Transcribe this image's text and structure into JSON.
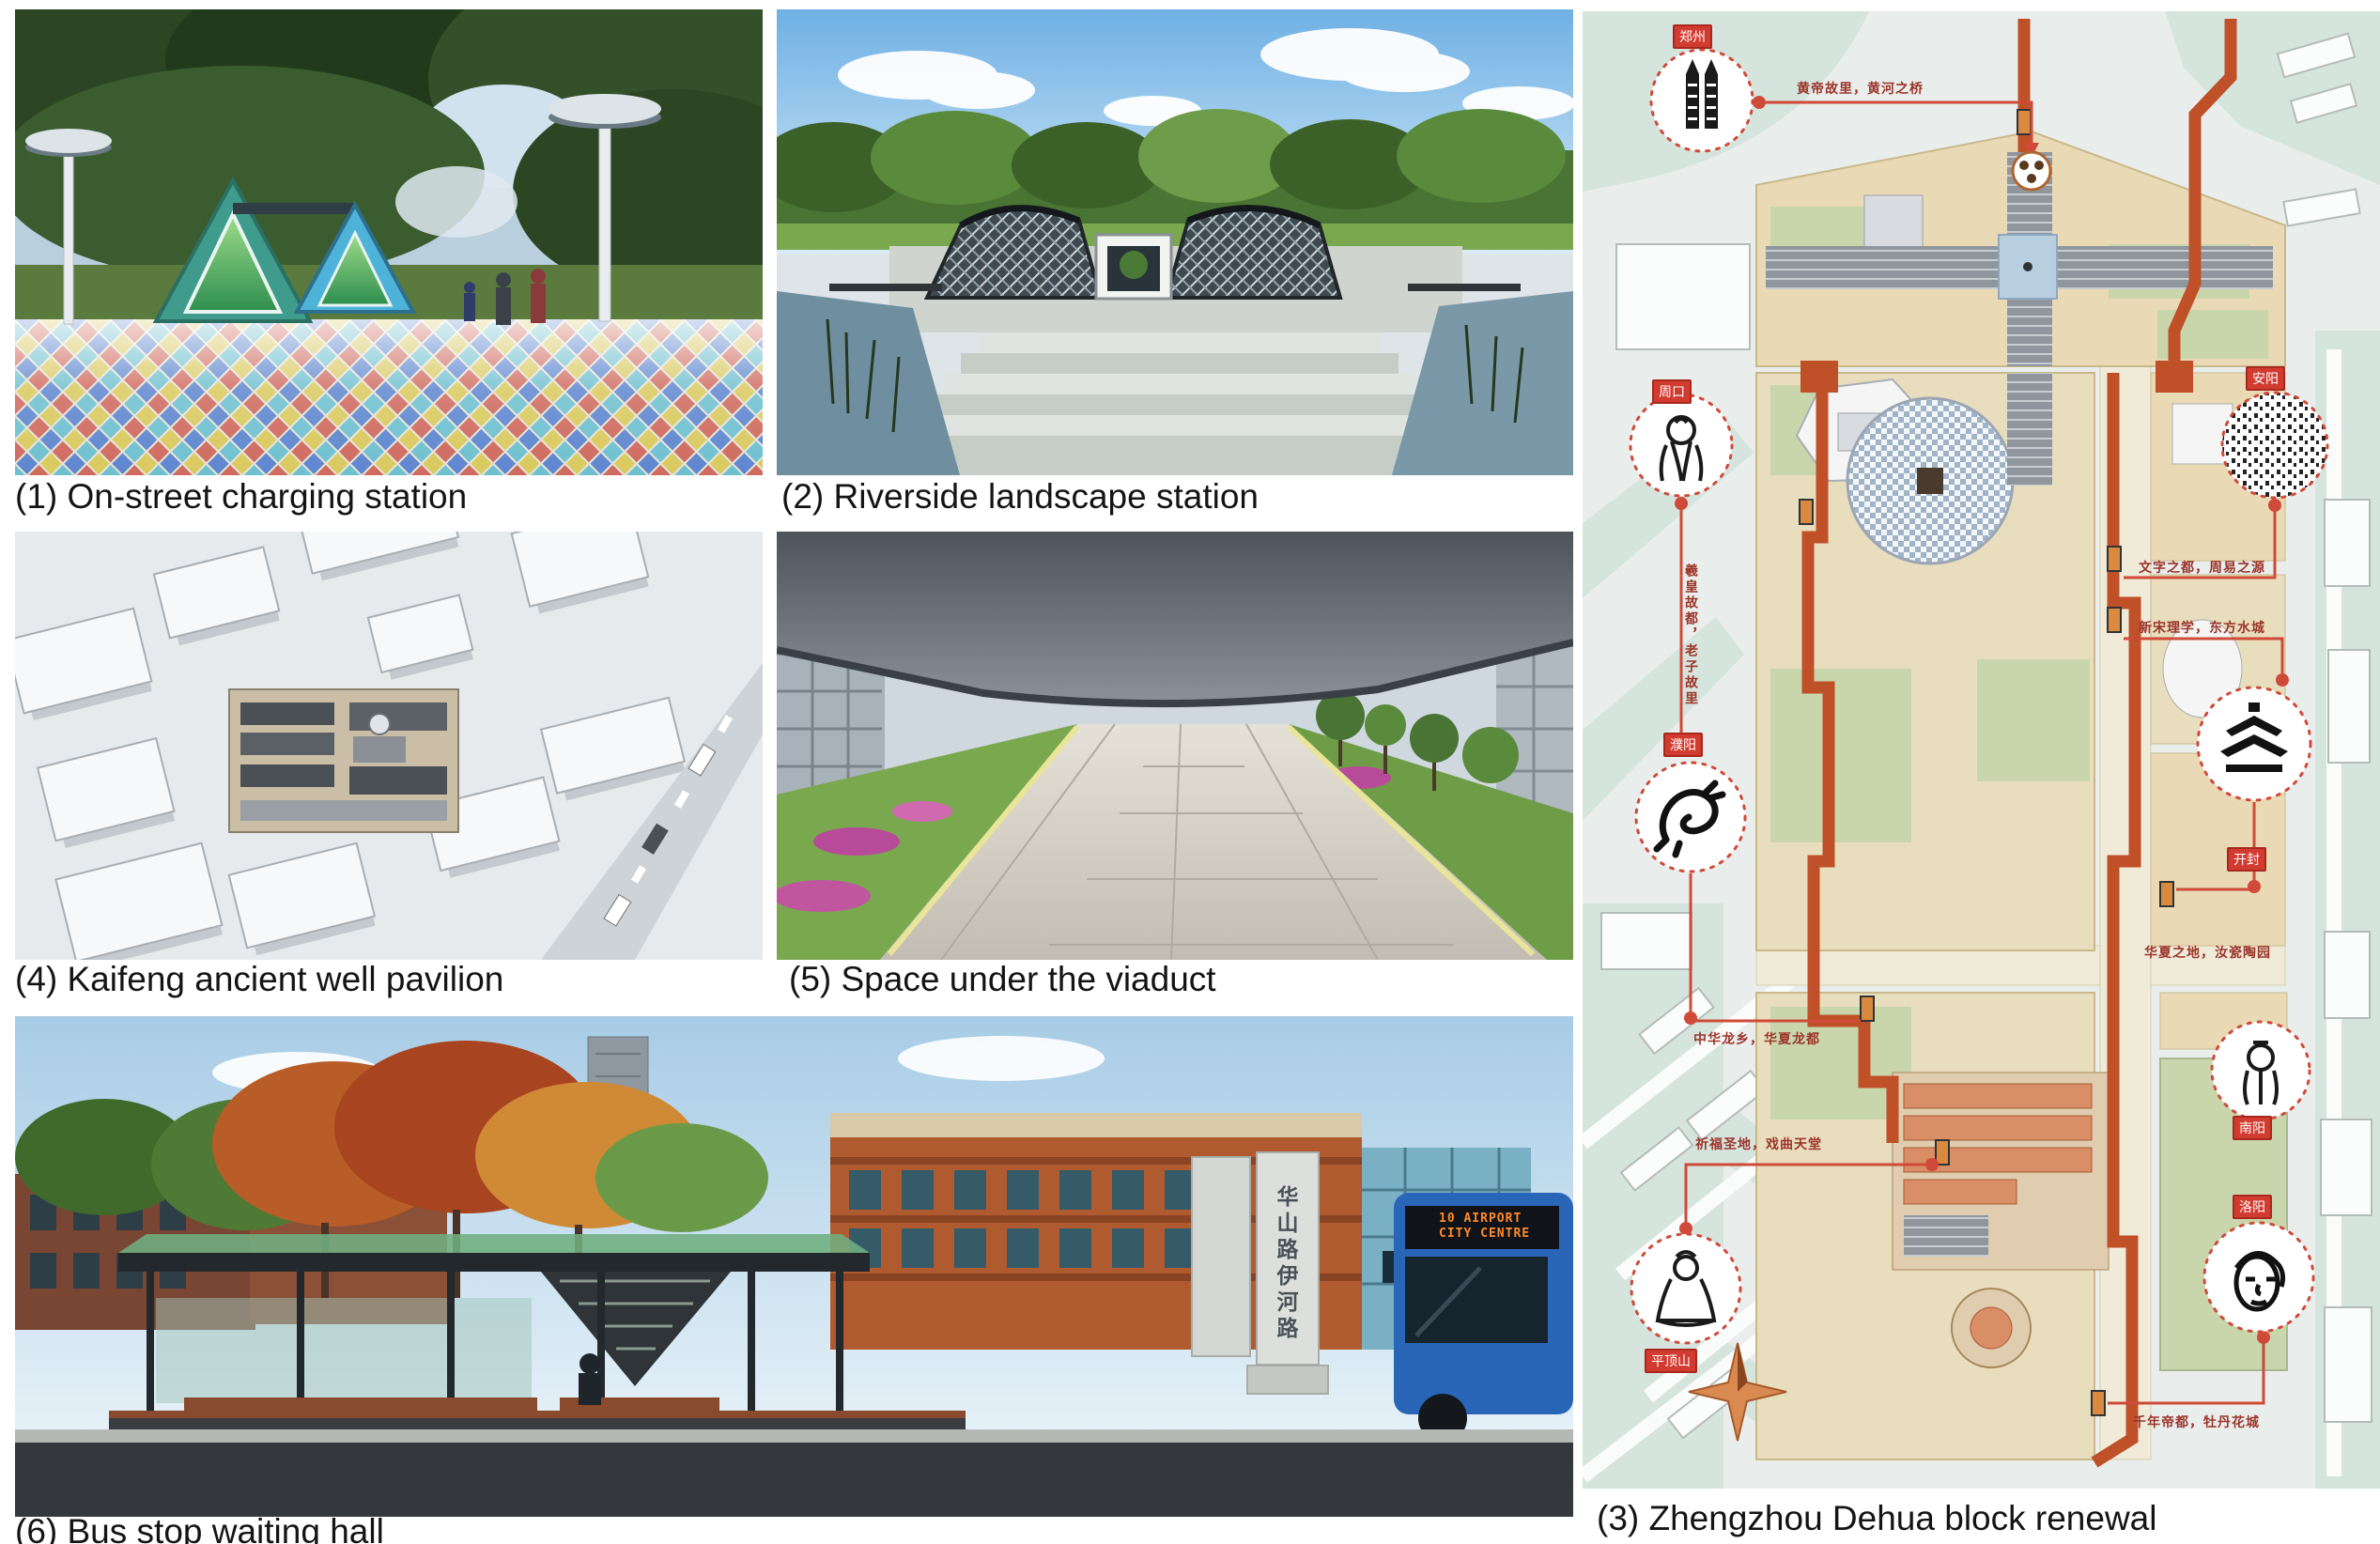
{
  "figure": {
    "captions": {
      "c1": "(1) On-street charging station",
      "c2": "(2) Riverside landscape station",
      "c3": "(3) Zhengzhou Dehua block renewal",
      "c4": "(4) Kaifeng ancient well pavilion",
      "c5": "(5) Space under the viaduct",
      "c6": "(6) Bus stop waiting hall"
    }
  },
  "panel6": {
    "road_sign_vertical": "华山路伊河路",
    "bus_led_line1": "10 AIRPORT",
    "bus_led_line2": "CITY CENTRE"
  },
  "map": {
    "vignettes": [
      {
        "city": "郑州",
        "icon": "erqi-tower-icon"
      },
      {
        "city": "周口",
        "icon": "laozi-portrait-icon"
      },
      {
        "city": "濮阳",
        "icon": "dragon-icon"
      },
      {
        "city": "安阳",
        "icon": "oracle-bone-script-icon"
      },
      {
        "city": "开封",
        "icon": "pagoda-roof-icon"
      },
      {
        "city": "南阳",
        "icon": "scholar-portrait-icon"
      },
      {
        "city": "洛阳",
        "icon": "buddha-head-icon"
      },
      {
        "city": "平顶山",
        "icon": "buddha-statue-icon"
      }
    ],
    "slogans": {
      "zhengzhou": "黄帝故里，黄河之桥",
      "zhoukou": "羲皇故都，老子故里",
      "anyang": "文字之都，周易之源",
      "kaifeng": "新宋理学，东方水城",
      "ruzhou": "华夏之地，汝瓷陶园",
      "puyang": "中华龙乡，华夏龙都",
      "pingdingshan": "祈福圣地，戏曲天堂",
      "luoyang": "千年帝都，牡丹花城"
    },
    "colors": {
      "route_orange": "#bf5028",
      "connector_red": "#cf4a38",
      "label_red": "#d23b2f",
      "block_beige": "#ead9b5",
      "block_green": "#c9d6ac",
      "street_teal": "#d6e4de"
    }
  }
}
